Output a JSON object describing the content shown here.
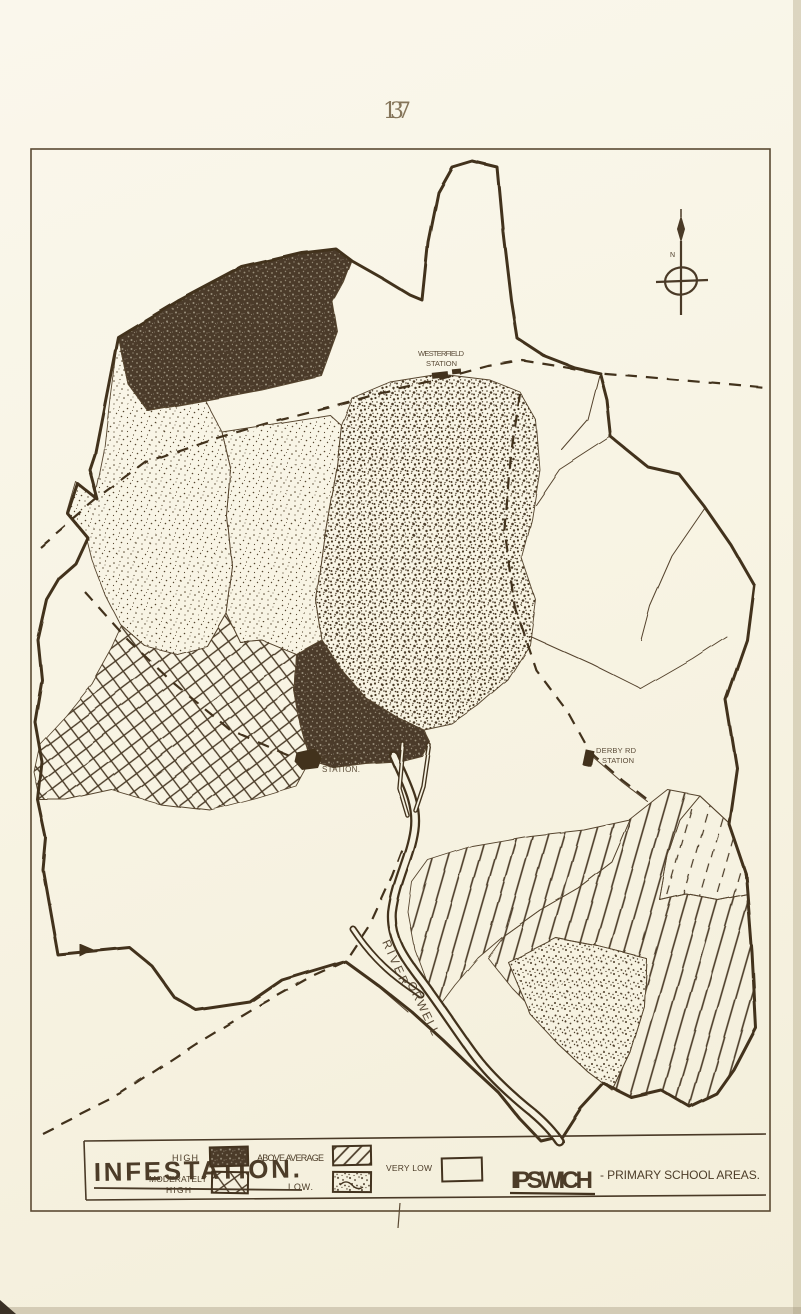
{
  "page": {
    "number": "137"
  },
  "legend": {
    "title": "INFESTATION.",
    "high_label": "HIGH",
    "moderately_high_line1": "MODERATELY",
    "moderately_high_line2": "HIGH",
    "above_average_label": "ABOVE AVERAGE",
    "low_label": "LOW.",
    "very_low_label": "VERY LOW",
    "area_title": "IPSWICH",
    "area_subtitle": "- PRIMARY SCHOOL AREAS."
  },
  "map": {
    "stations": [
      {
        "id": "westerfield",
        "line1": "WESTERFIELD",
        "line2": "STATION"
      },
      {
        "id": "ipswich",
        "line1": "IPSWICH",
        "line2": "STATION."
      },
      {
        "id": "derby-road",
        "line1": "DERBY RD",
        "line2": "STATION"
      }
    ],
    "river_label": {
      "line1": "RIVER",
      "line2": "ORWELL"
    },
    "compass_label": "N"
  },
  "colors": {
    "ink": "#4a3a27",
    "paper": "#f8f4e4"
  }
}
